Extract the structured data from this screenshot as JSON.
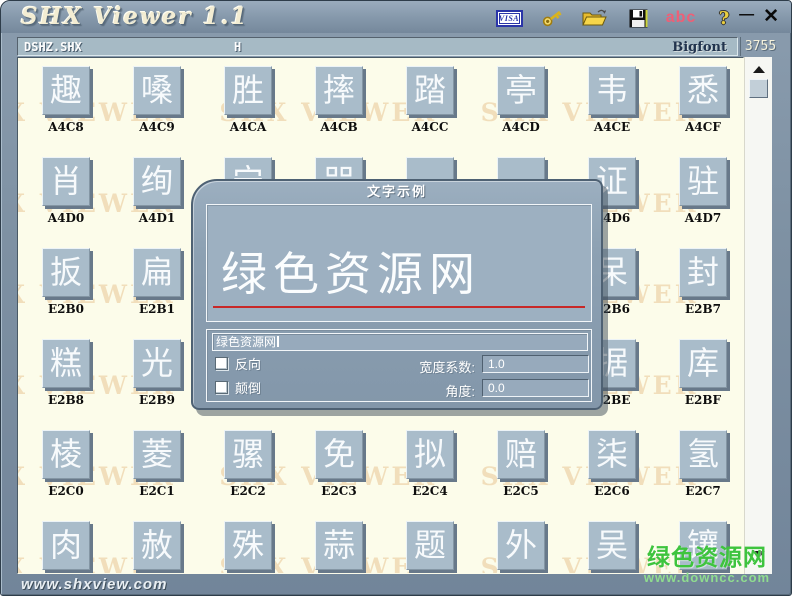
{
  "window": {
    "title": "SHX Viewer 1.1",
    "controls": {
      "minimize_glyph": "—",
      "close_glyph": "✕"
    }
  },
  "toolbar": {
    "visa_label": "VISA",
    "abc_label": "abc",
    "help_label": "?"
  },
  "status_bar": {
    "font_file": "DSHZ.SHX",
    "current_char": "H",
    "font_type": "Bigfont",
    "char_count": "3755"
  },
  "grid": {
    "watermark": "SHX VIEWER",
    "rows": [
      {
        "cells": [
          {
            "ch": "趣",
            "code": "A4C8"
          },
          {
            "ch": "嗓",
            "code": "A4C9"
          },
          {
            "ch": "胜",
            "code": "A4CA"
          },
          {
            "ch": "摔",
            "code": "A4CB"
          },
          {
            "ch": "踏",
            "code": "A4CC"
          },
          {
            "ch": "亭",
            "code": "A4CD"
          },
          {
            "ch": "韦",
            "code": "A4CE"
          },
          {
            "ch": "悉",
            "code": "A4CF"
          }
        ]
      },
      {
        "cells": [
          {
            "ch": "肖",
            "code": "A4D0"
          },
          {
            "ch": "绚",
            "code": "A4D1"
          },
          {
            "ch": "宁",
            "code": "A4D2"
          },
          {
            "ch": "咒",
            "code": "A4D3"
          },
          {
            "ch": "",
            "code": "A4D4"
          },
          {
            "ch": "",
            "code": "A4D5"
          },
          {
            "ch": "证",
            "code": "A4D6"
          },
          {
            "ch": "驻",
            "code": "A4D7"
          }
        ]
      },
      {
        "cells": [
          {
            "ch": "扳",
            "code": "E2B0"
          },
          {
            "ch": "扁",
            "code": "E2B1"
          },
          {
            "ch": "",
            "code": "E2B2"
          },
          {
            "ch": "",
            "code": "E2B3"
          },
          {
            "ch": "",
            "code": "E2B4"
          },
          {
            "ch": "",
            "code": "E2B5"
          },
          {
            "ch": "呆",
            "code": "E2B6"
          },
          {
            "ch": "封",
            "code": "E2B7"
          }
        ]
      },
      {
        "cells": [
          {
            "ch": "糕",
            "code": "E2B8"
          },
          {
            "ch": "光",
            "code": "E2B9"
          },
          {
            "ch": "",
            "code": "E2BA"
          },
          {
            "ch": "",
            "code": "E2BB"
          },
          {
            "ch": "",
            "code": "E2BC"
          },
          {
            "ch": "",
            "code": "E2BD"
          },
          {
            "ch": "据",
            "code": "E2BE"
          },
          {
            "ch": "库",
            "code": "E2BF"
          }
        ]
      },
      {
        "cells": [
          {
            "ch": "棱",
            "code": "E2C0"
          },
          {
            "ch": "菱",
            "code": "E2C1"
          },
          {
            "ch": "骡",
            "code": "E2C2"
          },
          {
            "ch": "免",
            "code": "E2C3"
          },
          {
            "ch": "拟",
            "code": "E2C4"
          },
          {
            "ch": "赔",
            "code": "E2C5"
          },
          {
            "ch": "柒",
            "code": "E2C6"
          },
          {
            "ch": "氢",
            "code": "E2C7"
          }
        ]
      },
      {
        "cells": [
          {
            "ch": "肉",
            "code": ""
          },
          {
            "ch": "赦",
            "code": ""
          },
          {
            "ch": "殊",
            "code": ""
          },
          {
            "ch": "蒜",
            "code": ""
          },
          {
            "ch": "题",
            "code": ""
          },
          {
            "ch": "外",
            "code": ""
          },
          {
            "ch": "吴",
            "code": ""
          },
          {
            "ch": "镶",
            "code": ""
          }
        ]
      }
    ]
  },
  "dialog": {
    "title": "文字示例",
    "preview_text": "绿色资源网",
    "input_value": "绿色资源网",
    "reverse_label": "反向",
    "upside_down_label": "颠倒",
    "width_label": "宽度系数:",
    "width_value": "1.0",
    "angle_label": "角度:",
    "angle_value": "0.0"
  },
  "footer": {
    "site_url": "www.shxview.com"
  },
  "green_watermark": {
    "line1": "绿色资源网",
    "line2": "www.downcc.com"
  },
  "colors": {
    "frame": "#7e91a3",
    "content_bg": "#fcfcea",
    "tile": "#a9bcca",
    "dialog": "#8da1b3",
    "underline_red": "#c82828",
    "watermark_tan": "#ebcea3",
    "watermark_green": "#3ec43e",
    "abc_pink": "#ee5f76"
  }
}
